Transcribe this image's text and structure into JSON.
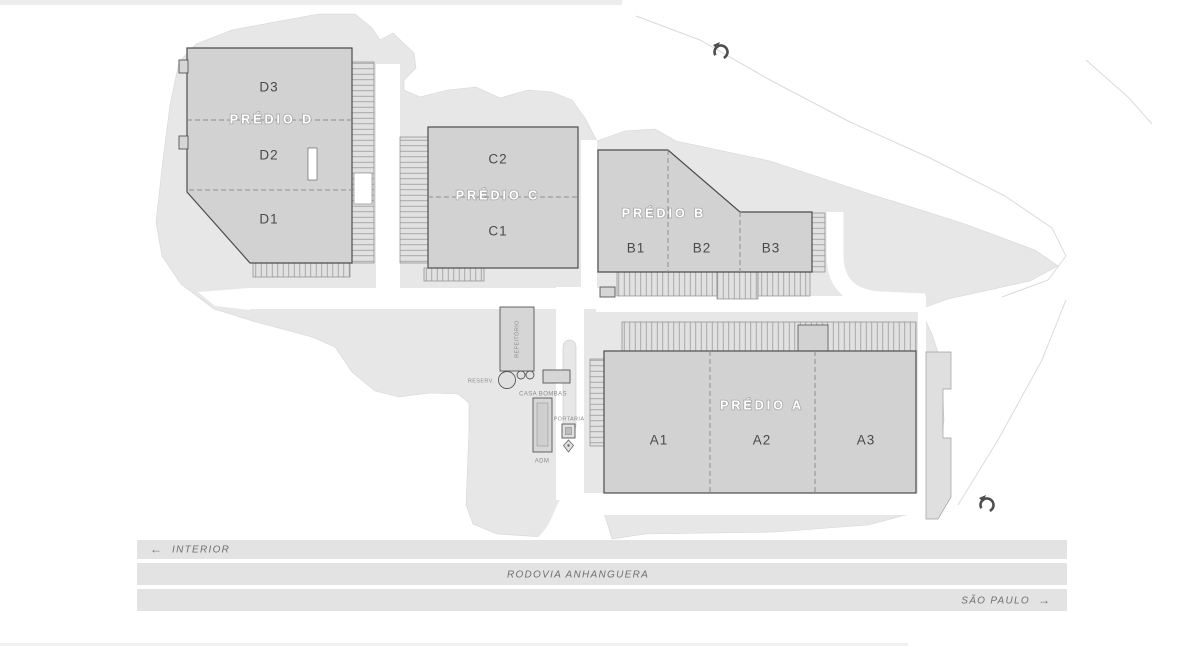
{
  "buildings": [
    {
      "id": "D",
      "label": "PRÉDIO D",
      "units": [
        "D3",
        "D2",
        "D1"
      ]
    },
    {
      "id": "C",
      "label": "PRÉDIO C",
      "units": [
        "C2",
        "C1"
      ]
    },
    {
      "id": "B",
      "label": "PRÉDIO B",
      "units": [
        "B1",
        "B2",
        "B3"
      ]
    },
    {
      "id": "A",
      "label": "PRÉDIO A",
      "units": [
        "A1",
        "A2",
        "A3"
      ]
    }
  ],
  "facilities": {
    "refeitorio": "REFEITÓRIO",
    "casa_bombas": "CASA BOMBAS",
    "portaria": "PORTARIA",
    "adm": "ADM",
    "reservatorio": "RESERV."
  },
  "highway": {
    "name": "RODOVIA ANHANGUERA",
    "direction_left": "INTERIOR",
    "arrow_left": "←",
    "direction_right": "SÃO PAULO",
    "arrow_right": "→"
  },
  "icons": {
    "north_arrow": "north-arrow-icon"
  },
  "colors": {
    "background": "#ffffff",
    "terrain": "#e7e7e7",
    "building_fill": "#d2d2d2",
    "building_outline": "#4d4d4d",
    "dock_fill": "#e1e1e1",
    "internal_road": "#ffffff",
    "highway_band": "#e3e3e3",
    "unit_text": "#4a4a4a",
    "building_text": "#ffffff",
    "small_text": "#8a8a8a",
    "highway_text": "#6f6f6f"
  }
}
